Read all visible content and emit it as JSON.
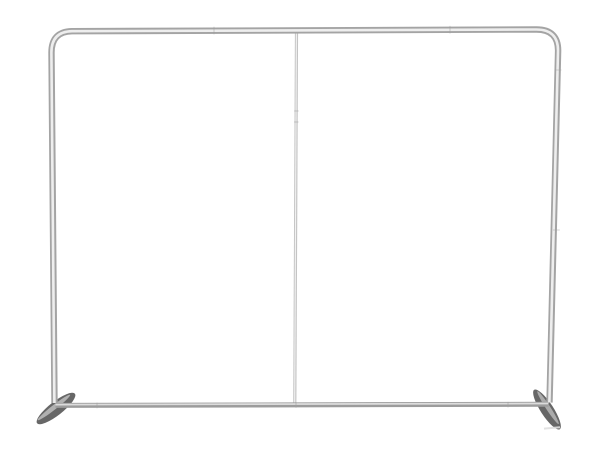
{
  "image": {
    "description": "Product photo of an empty silver aluminum tube frame for a tension-fabric backdrop display stand, front view, two stabilizer feet, on a plain white background",
    "background": "#ffffff"
  },
  "objects": {
    "frame": "rounded-corner aluminum tube frame (left upright, top crossbar, right upright)",
    "top_crossbar": "horizontal top tube",
    "left_upright": "left vertical tube",
    "right_upright": "right vertical tube",
    "center_pole": "thin central support pole",
    "bottom_crossbar": "horizontal bottom tube",
    "left_foot": "flat angled stabilizer foot, left",
    "right_foot": "flat angled stabilizer foot, right"
  },
  "colors": {
    "background": "#ffffff",
    "tube_edge": "#a4a4a4",
    "tube_highlight": "#eeeeee",
    "pole": "#c4c4c4",
    "pole_highlight": "#f2f2f2",
    "bottom_bar": "#9c9c9c",
    "bottom_bar_highlight": "#dcdcdc",
    "seam": "#9f9f9f",
    "foot": "#676767",
    "foot_highlight": "#c9c9c9",
    "foot_tip_light": "#dfdfdf"
  }
}
